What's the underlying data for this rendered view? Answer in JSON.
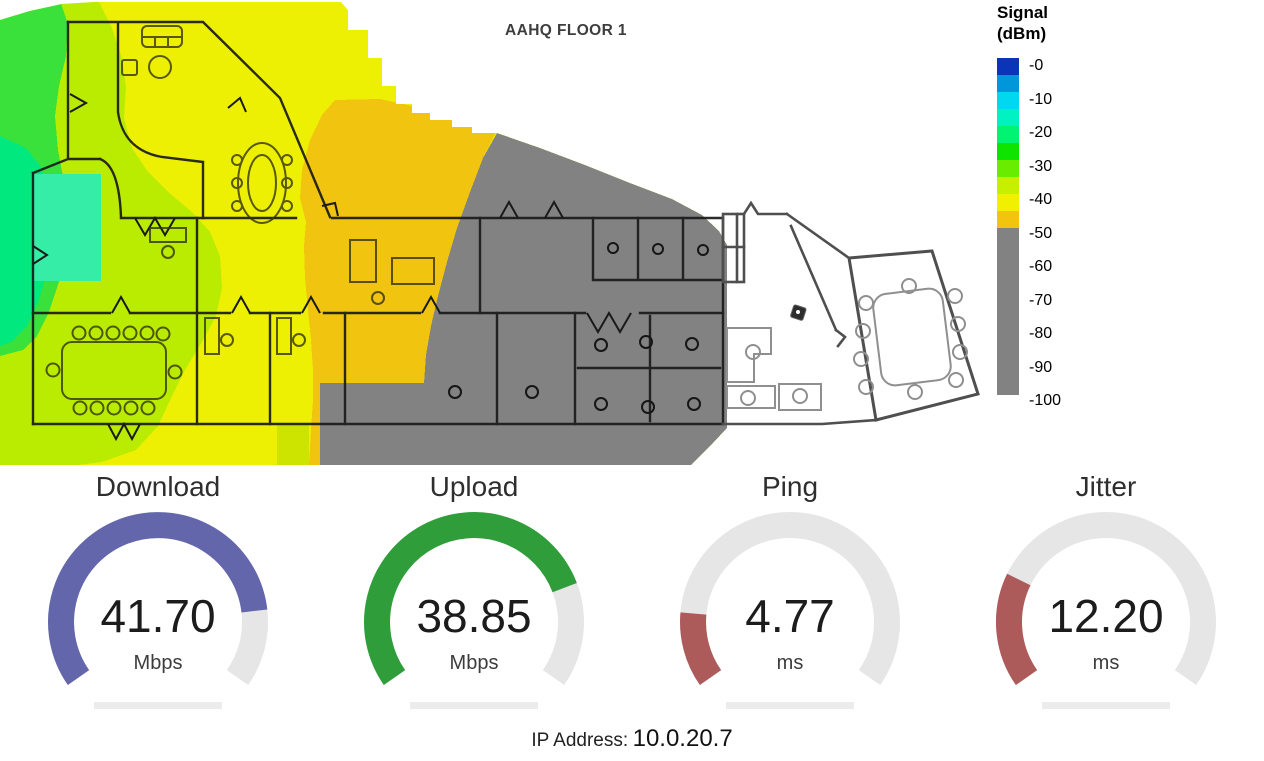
{
  "heatmap": {
    "title": "AAHQ FLOOR 1",
    "legend": {
      "title_line1": "Signal",
      "title_line2": "(dBm)",
      "ticks": [
        "-0",
        "-10",
        "-20",
        "-30",
        "-40",
        "-50",
        "-60",
        "-70",
        "-80",
        "-90",
        "-100"
      ],
      "colors": [
        "#0b35b8",
        "#0096da",
        "#00d8f0",
        "#00f1c2",
        "#00f373",
        "#0fe400",
        "#68ec00",
        "#c6f000",
        "#f0f000",
        "#f2c40e"
      ],
      "gray": "#828282",
      "band_height_px": 17,
      "gray_height_px": 167
    },
    "palette": {
      "yellow": "#edf003",
      "yellow_green": "#b9ec00",
      "green": "#3ae13a",
      "spring_green": "#00e87e",
      "mint": "#35eda6",
      "orange": "#f1c40f",
      "gray": "#828282"
    }
  },
  "gauges": [
    {
      "label": "Download",
      "value": "41.70",
      "unit": "Mbps",
      "color": "#6366ab",
      "fraction": 0.834
    },
    {
      "label": "Upload",
      "value": "38.85",
      "unit": "Mbps",
      "color": "#2f9d3a",
      "fraction": 0.777
    },
    {
      "label": "Ping",
      "value": "4.77",
      "unit": "ms",
      "color": "#ad5a5a",
      "fraction": 0.16
    },
    {
      "label": "Jitter",
      "value": "12.20",
      "unit": "ms",
      "color": "#ad5a5a",
      "fraction": 0.244
    }
  ],
  "gauge_style": {
    "track_color": "#e6e6e6",
    "bar_color": "#ececec"
  },
  "footer": {
    "ip_label": "IP Address:",
    "ip_value": "10.0.20.7"
  }
}
